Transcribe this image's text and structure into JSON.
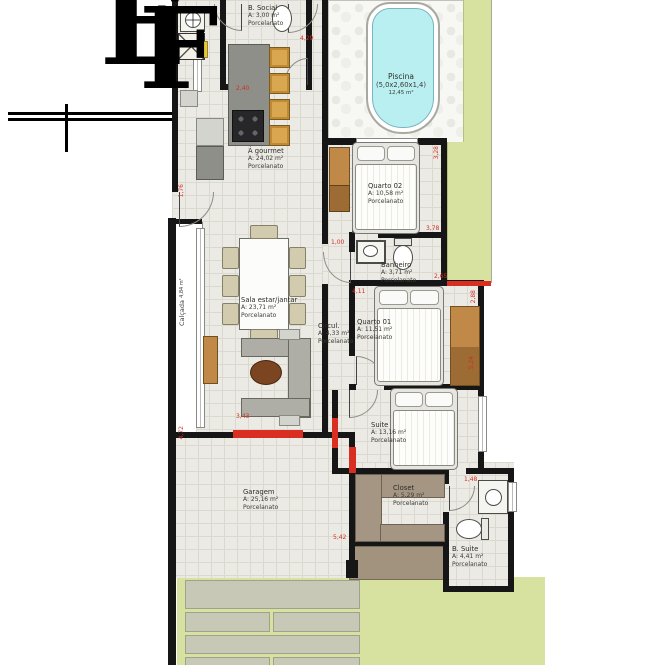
{
  "logo": {
    "letter_e": "E",
    "letter_f": "F"
  },
  "rooms": [
    {
      "name": "Piscina",
      "dims": "(5,0x2,60x1,4)",
      "area": "12,45 m²"
    },
    {
      "name": "B. Social",
      "area": "A: 3,00 m²",
      "floor": "Porcelanato"
    },
    {
      "name": "Á gourmet",
      "area": "A: 24,02 m²",
      "floor": "Porcelanato"
    },
    {
      "name": "Quarto 02",
      "area": "A: 10,58 m²",
      "floor": "Porcelanato"
    },
    {
      "name": "Banheiro",
      "area": "A: 3,71 m²",
      "floor": "Porcelanato"
    },
    {
      "name": "Circul.",
      "area": "A: 4,33 m²",
      "floor": "Porcelanato"
    },
    {
      "name": "Quarto 01",
      "area": "A: 11,51 m²",
      "floor": "Porcelanato"
    },
    {
      "name": "Sala estar/jantar",
      "area": "A: 23,71 m²",
      "floor": "Porcelanato"
    },
    {
      "name": "Suite",
      "area": "A: 13,16 m²",
      "floor": "Porcelanato"
    },
    {
      "name": "Closet",
      "area": "A: 5,29 m²",
      "floor": "Porcelanato"
    },
    {
      "name": "B. Suite",
      "area": "A: 4,41 m²",
      "floor": "Porcelanato"
    },
    {
      "name": "Garagem",
      "area": "A: 25,16 m²",
      "floor": "Porcelanato"
    },
    {
      "name": "Calçada",
      "area": "4,84 m²"
    }
  ],
  "dims": {
    "d240": "2,40",
    "d429": "4,29",
    "d328": "3,28",
    "d378": "3,78",
    "d100": "1,00",
    "d265": "2,65",
    "d411": "4,11",
    "d288": "2,88",
    "d524": "5,24",
    "d343": "3,43",
    "d542": "5,42",
    "d148": "1,48",
    "d472": "4,72",
    "d176": "1,76"
  },
  "colors": {
    "wall": "#161616",
    "dimension_red": "#d92f22",
    "lawn_green": "#d7e2a0",
    "pool_water": "#b9eff0",
    "floor": "#eceae4",
    "wood_tan": "#c08948"
  }
}
